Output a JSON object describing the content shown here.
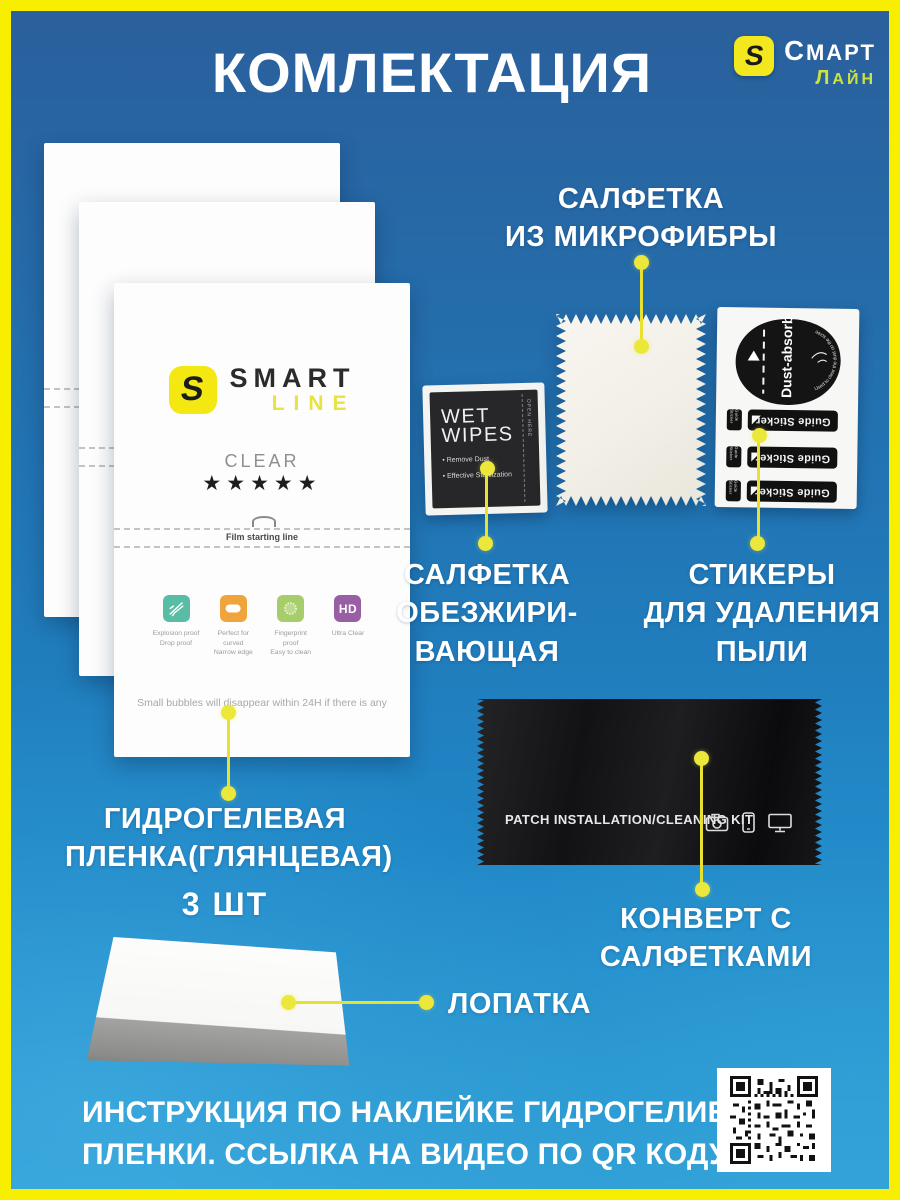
{
  "header": {
    "title": "КОМЛЕКТАЦИЯ",
    "brand": {
      "logo_letter": "S",
      "name": "СМАРТ",
      "suffix": "ЛАЙН"
    }
  },
  "film_packet": {
    "logo_letter": "S",
    "brand_top": "SMART",
    "brand_bottom": "LINE",
    "variant": "CLEAR",
    "stars": "★★★★★",
    "start_line_label": "Film starting line",
    "features": [
      {
        "icon": "scratch-proof",
        "cap1": "Explosion proof",
        "cap2": "Drop proof"
      },
      {
        "icon": "curved-edge",
        "cap1": "Perfect for curved",
        "cap2": "Narrow edge"
      },
      {
        "icon": "fingerprint-proof",
        "cap1": "Fingerprint proof",
        "cap2": "Easy to clean"
      },
      {
        "icon": "hd",
        "icon_text": "HD",
        "cap1": "Ultra Clear",
        "cap2": ""
      }
    ],
    "note": "Small bubbles will disappear within 24H if there is any"
  },
  "wet_wipes": {
    "title_line1": "WET",
    "title_line2": "WIPES",
    "bullet1": "• Remove Dust",
    "bullet2": "• Effective Sterilization",
    "side_text": "OPEN HERE"
  },
  "sticker_sheet": {
    "dust_label": "Dust-absorber",
    "dust_note": "Used to clear the dust on the screen",
    "guide_label": "Guide Sticker"
  },
  "envelope": {
    "label": "PATCH INSTALLATION/CLEANING KIT",
    "icons": [
      "camera",
      "smartphone",
      "monitor"
    ]
  },
  "callouts": {
    "microfiber": {
      "line1": "САЛФЕТКА",
      "line2": "ИЗ МИКРОФИБРЫ"
    },
    "degreasing": {
      "line1": "САЛФЕТКА",
      "line2": "ОБЕЗЖИРИ-",
      "line3": "ВАЮЩАЯ"
    },
    "dust_stickers": {
      "line1": "СТИКЕРЫ",
      "line2": "ДЛЯ УДАЛЕНИЯ",
      "line3": "ПЫЛИ"
    },
    "film": {
      "line1": "ГИДРОГЕЛЕВАЯ",
      "line2": "ПЛЕНКА(ГЛЯНЦЕВАЯ)",
      "qty": "3 ШТ"
    },
    "envelope": {
      "line1": "КОНВЕРТ С",
      "line2": "САЛФЕТКАМИ"
    },
    "spatula": {
      "label": "ЛОПАТКА"
    }
  },
  "footer": {
    "line1": "ИНСТРУКЦИЯ ПО НАКЛЕЙКЕ ГИДРОГЕЛИЕВОЙ",
    "line2": "ПЛЕНКИ. ССЫЛКА НА ВИДЕО ПО QR КОДУ:"
  },
  "colors": {
    "frame_yellow": "#f8ee00",
    "accent_yellow": "#ebe636",
    "background_blue": "#2180be",
    "film_logo_yellow": "#f4e813"
  }
}
